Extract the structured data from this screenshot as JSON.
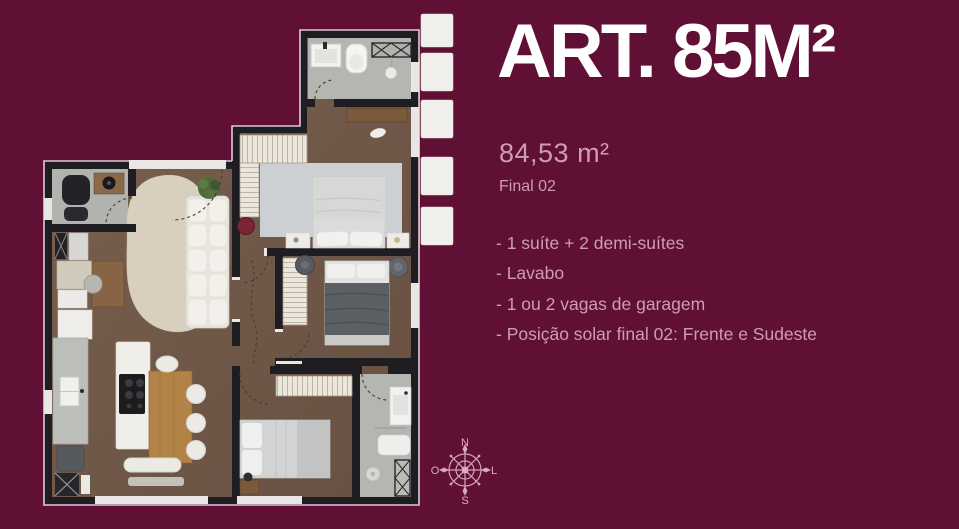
{
  "heading": {
    "title": "ART. 85M²"
  },
  "details": {
    "area": "84,53 m²",
    "unit": "Final 02"
  },
  "features": [
    {
      "text": "- 1 suíte + 2 demi-suítes"
    },
    {
      "text": "- Lavabo"
    },
    {
      "text": "- 1 ou 2 vagas de garagem"
    },
    {
      "text": "- Posição solar final 02: Frente e Sudeste"
    }
  ],
  "compass": {
    "north": "N",
    "south": "S",
    "east": "L",
    "west": "O"
  },
  "floorplan": {
    "type": "apartment-floor-plan",
    "louver_count": 5,
    "depicted_rooms": [
      "suite-bathroom",
      "suite",
      "demi-suite-2",
      "demi-suite-1",
      "second-bathroom",
      "lavabo",
      "living-room",
      "kitchen",
      "hallway"
    ]
  },
  "colors": {
    "background": "#5F1034",
    "title_text": "#FFFFFF",
    "accent_text": "#CE9DB3",
    "plan_wall": "#1E1E22",
    "wood_floor": "#73594A",
    "tile_floor": "#B3B6B1",
    "plan_outline": "#E3C8D4",
    "compass": "#DBAEC2"
  }
}
